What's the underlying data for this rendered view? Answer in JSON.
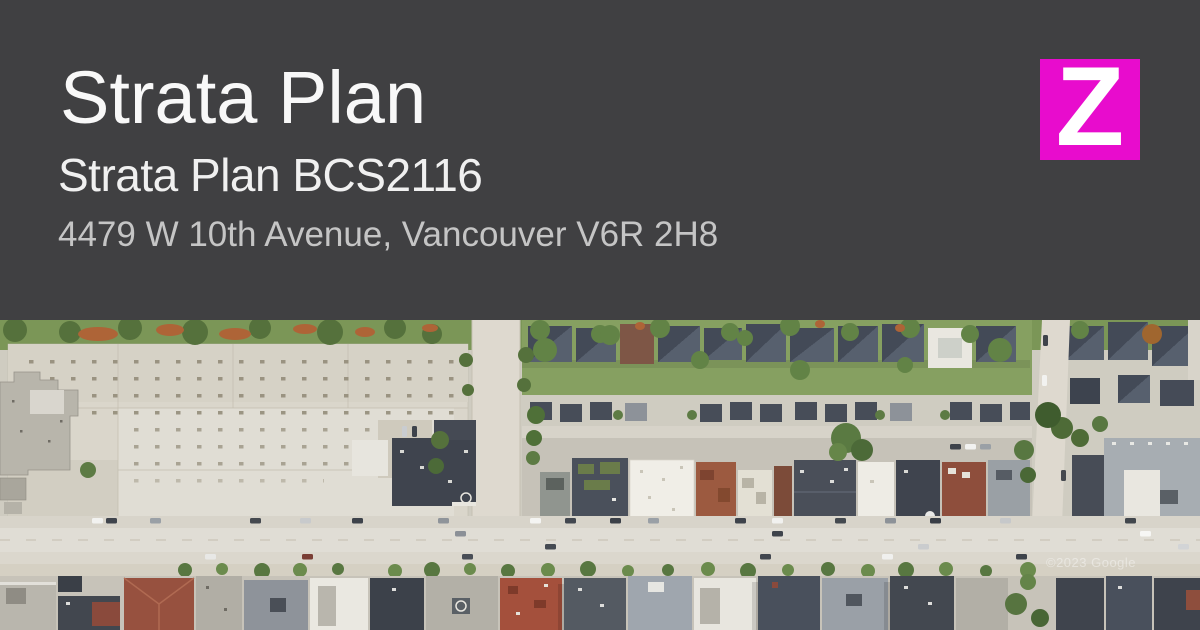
{
  "header": {
    "title": "Strata Plan",
    "subtitle": "Strata Plan BCS2116",
    "address": "4479 W 10th Avenue, Vancouver V6R 2H8",
    "background_color": "#404042",
    "title_color": "#f8f8f8",
    "subtitle_color": "#f0f0f0",
    "address_color": "#c5c5c5"
  },
  "logo": {
    "letter": "Z",
    "background_color": "#E80CCD",
    "letter_color": "#ffffff"
  },
  "map": {
    "type": "aerial-satellite-photo",
    "street_shown": "W 10th Avenue, Vancouver",
    "watermark": "©2023 Google",
    "palette": {
      "ground": "#cfccc1",
      "road": "#e0ddd5",
      "construction_site": "#dad6cb",
      "greenery": "#7b9657",
      "dark_roof": "#454b56",
      "red_roof": "#96503f",
      "white_roof": "#efede6",
      "dirt": "#ae6437"
    }
  }
}
